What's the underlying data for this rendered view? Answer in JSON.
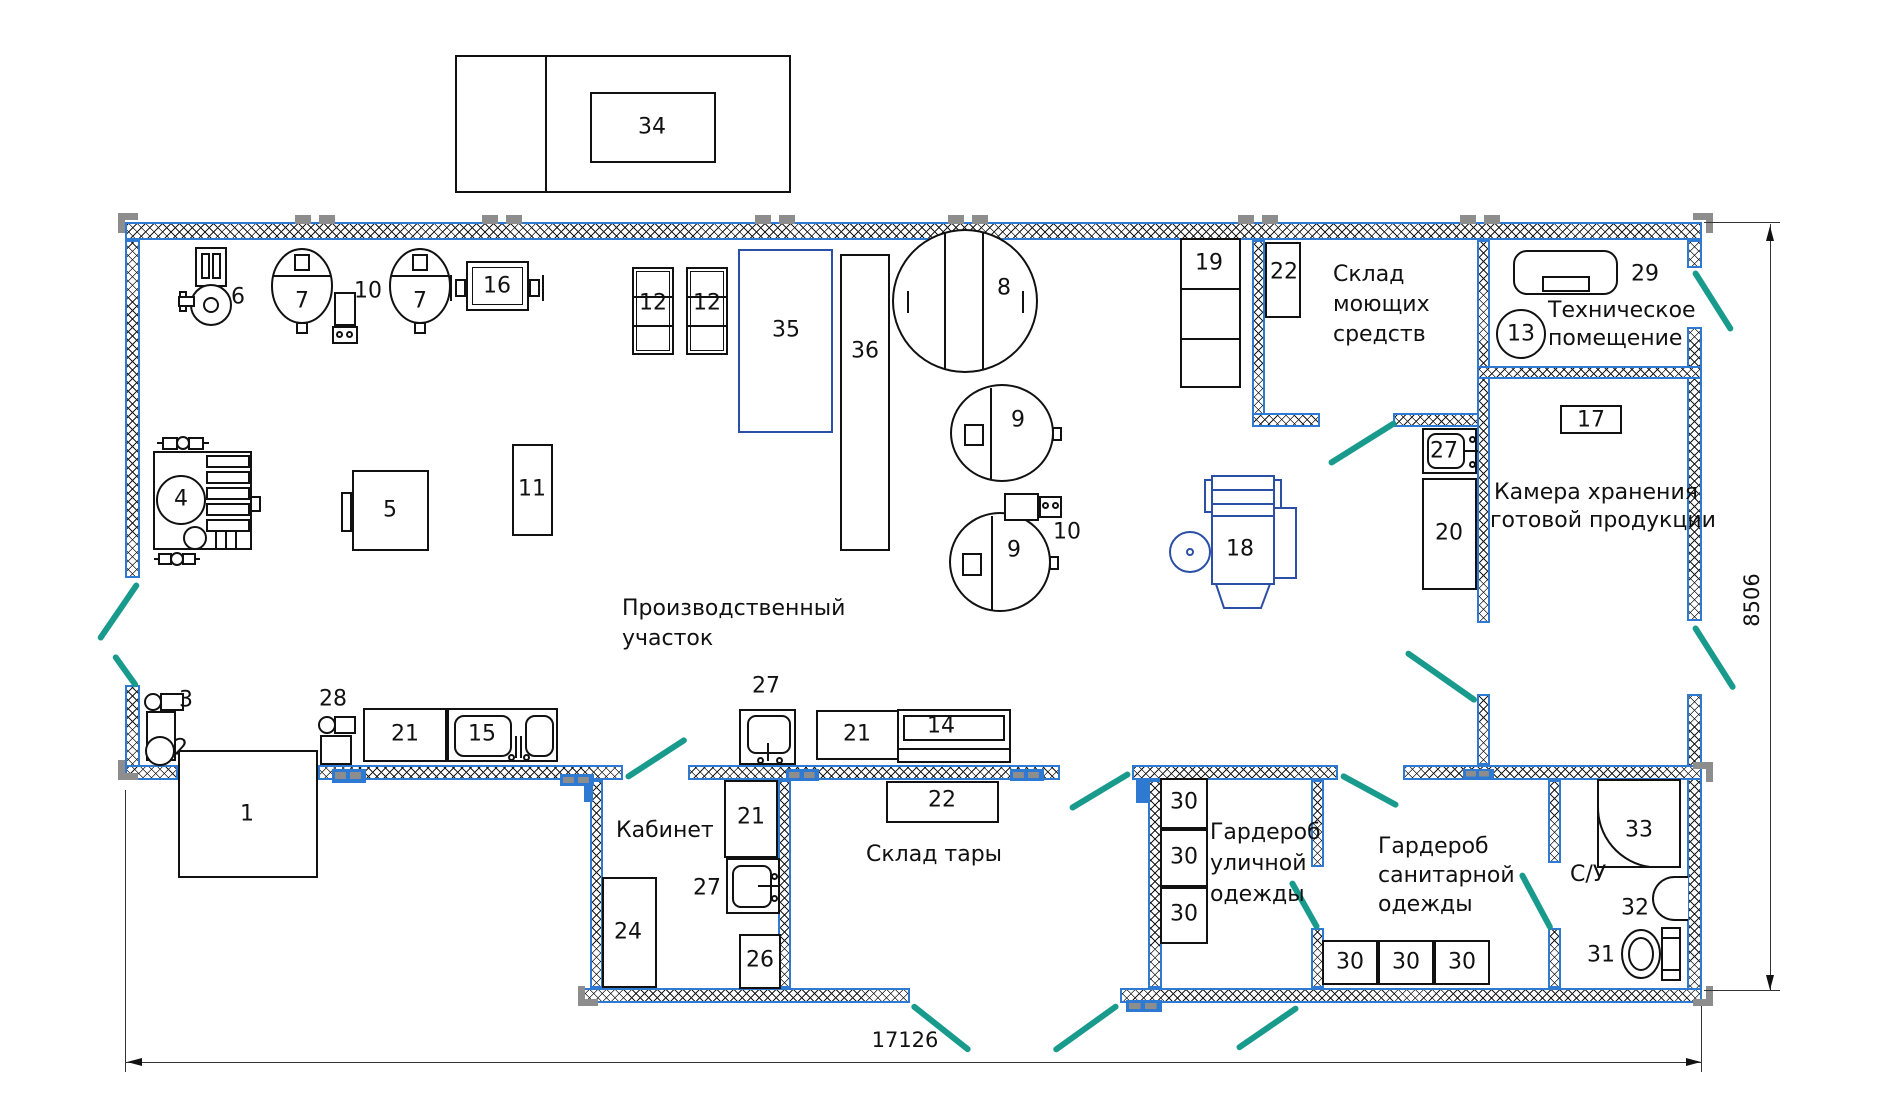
{
  "drawing": {
    "type": "factory floor plan",
    "colors": {
      "wall_blue": "#2e7ad2",
      "door_teal": "#189a8c",
      "equipment_blue": "#2b4fa5"
    }
  },
  "nums": {
    "1": "1",
    "2": "2",
    "3": "3",
    "4": "4",
    "5": "5",
    "6": "6",
    "7": "7",
    "8": "8",
    "9": "9",
    "10": "10",
    "11": "11",
    "12": "12",
    "13": "13",
    "14": "14",
    "15": "15",
    "16": "16",
    "17": "17",
    "18": "18",
    "19": "19",
    "20": "20",
    "21": "21",
    "22": "22",
    "24": "24",
    "26": "26",
    "27": "27",
    "28": "28",
    "29": "29",
    "30": "30",
    "31": "31",
    "32": "32",
    "33": "33",
    "34": "34",
    "35": "35",
    "36": "36"
  },
  "rooms": {
    "production": [
      "Производственный",
      "участок"
    ],
    "detergent": [
      "Склад",
      "моющих",
      "средств"
    ],
    "technical": [
      "Техническое",
      "помещение"
    ],
    "storage": [
      "Камера хранения",
      "готовой продукции"
    ],
    "office": "Кабинет",
    "container": "Склад тары",
    "street_wardrobe": [
      "Гардероб",
      "уличной",
      "одежды"
    ],
    "sanitary_wardrobe": [
      "Гардероб",
      "санитарной",
      "одежды"
    ],
    "wc": "С/У"
  },
  "dimensions": {
    "width": "17126",
    "height": "8506"
  }
}
